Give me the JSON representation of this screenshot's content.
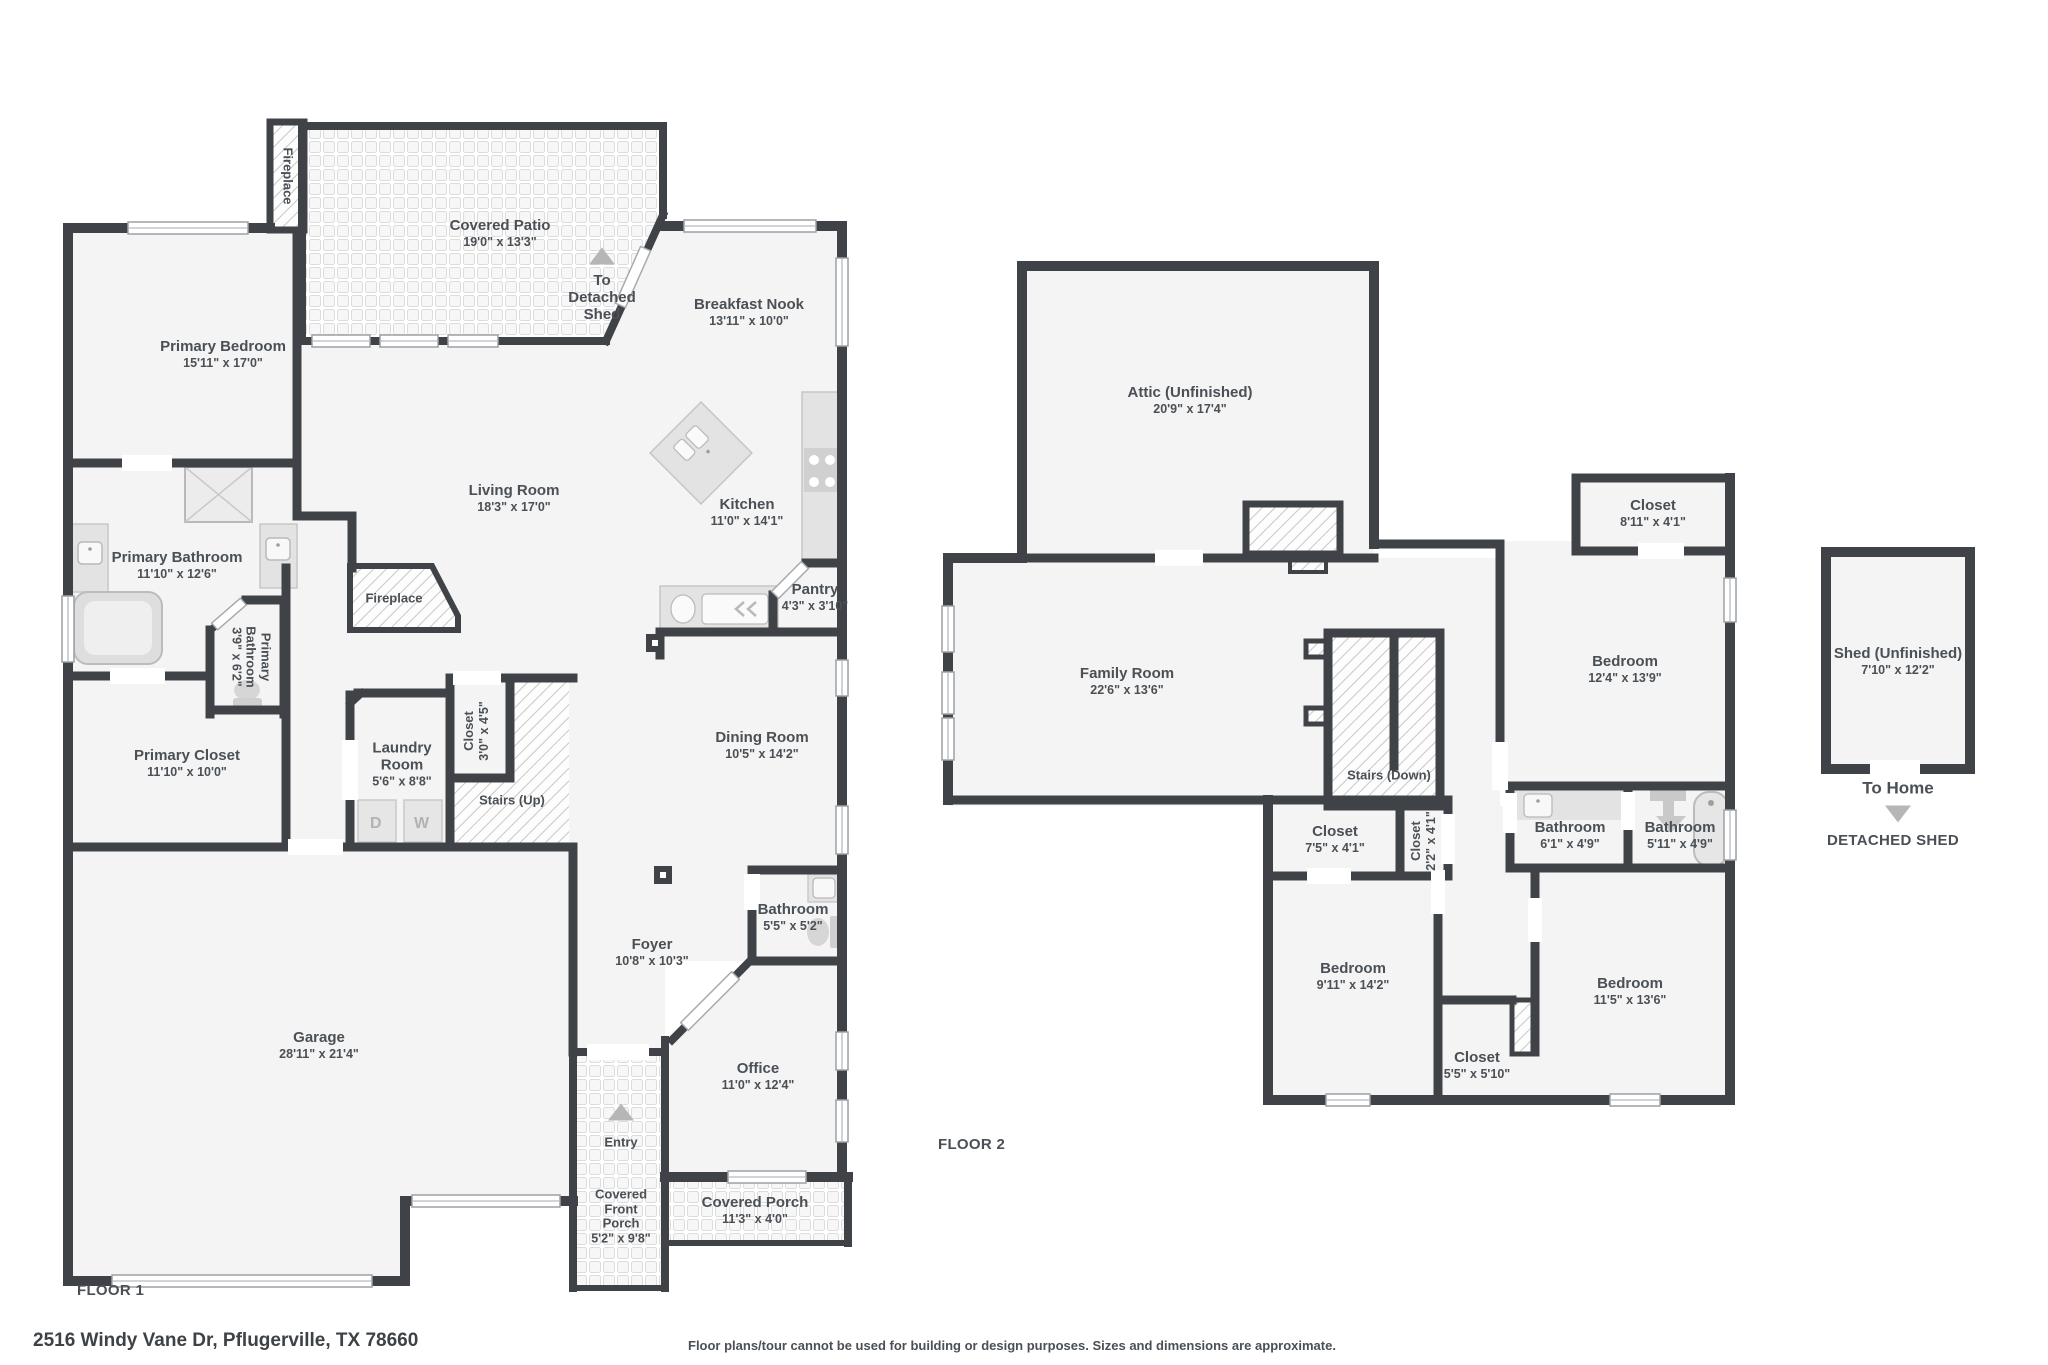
{
  "meta": {
    "address": "2516 Windy Vane Dr, Pflugerville, TX 78660",
    "disclaimer": "Floor plans/tour cannot be used for building or design purposes. Sizes and dimensions are approximate.",
    "wall_color": "#3f4347",
    "room_fill": "#f4f4f4",
    "text_color": "#4a5055"
  },
  "floor1": {
    "label": "FLOOR 1",
    "rooms": {
      "chimney_fireplace": {
        "name": "Fireplace"
      },
      "covered_patio": {
        "name": "Covered Patio",
        "dims": "19'0\" x 13'3\""
      },
      "to_detached_shed": {
        "name": "To Detached Shed"
      },
      "breakfast_nook": {
        "name": "Breakfast Nook",
        "dims": "13'11\" x 10'0\""
      },
      "primary_bedroom": {
        "name": "Primary Bedroom",
        "dims": "15'11\" x 17'0\""
      },
      "living_room": {
        "name": "Living Room",
        "dims": "18'3\" x 17'0\""
      },
      "kitchen": {
        "name": "Kitchen",
        "dims": "11'0\" x 14'1\""
      },
      "primary_bathroom": {
        "name": "Primary Bathroom",
        "dims": "11'10\" x 12'6\""
      },
      "fireplace": {
        "name": "Fireplace"
      },
      "pantry": {
        "name": "Pantry",
        "dims": "4'3\" x 3'10\""
      },
      "primary_bathroom_wc": {
        "name": "Primary Bathroom",
        "dims": "3'9\" x 6'2\""
      },
      "primary_closet": {
        "name": "Primary Closet",
        "dims": "11'10\" x 10'0\""
      },
      "laundry_room": {
        "name": "Laundry Room",
        "dims": "5'6\" x 8'8\""
      },
      "closet": {
        "name": "Closet",
        "dims": "3'0\" x 4'5\""
      },
      "stairs_up": {
        "name": "Stairs (Up)"
      },
      "dining_room": {
        "name": "Dining Room",
        "dims": "10'5\" x 14'2\""
      },
      "bathroom": {
        "name": "Bathroom",
        "dims": "5'5\" x 5'2\""
      },
      "foyer": {
        "name": "Foyer",
        "dims": "10'8\" x 10'3\""
      },
      "garage": {
        "name": "Garage",
        "dims": "28'11\" x 21'4\""
      },
      "entry": {
        "name": "Entry"
      },
      "covered_front_porch": {
        "name": "Covered Front Porch",
        "dims": "5'2\" x 9'8\""
      },
      "office": {
        "name": "Office",
        "dims": "11'0\" x 12'4\""
      },
      "covered_porch": {
        "name": "Covered Porch",
        "dims": "11'3\" x 4'0\""
      }
    },
    "appliances": {
      "dryer": "D",
      "washer": "W"
    }
  },
  "floor2": {
    "label": "FLOOR 2",
    "rooms": {
      "attic": {
        "name": "Attic (Unfinished)",
        "dims": "20'9\" x 17'4\""
      },
      "family_room": {
        "name": "Family Room",
        "dims": "22'6\" x 13'6\""
      },
      "stairs_down": {
        "name": "Stairs (Down)"
      },
      "closet_75": {
        "name": "Closet",
        "dims": "7'5\" x 4'1\""
      },
      "closet_22": {
        "name": "Closet",
        "dims": "2'2\" x 4'1\""
      },
      "closet_811": {
        "name": "Closet",
        "dims": "8'11\" x 4'1\""
      },
      "bedroom_124": {
        "name": "Bedroom",
        "dims": "12'4\" x 13'9\""
      },
      "bathroom_61": {
        "name": "Bathroom",
        "dims": "6'1\" x 4'9\""
      },
      "bathroom_511": {
        "name": "Bathroom",
        "dims": "5'11\" x 4'9\""
      },
      "bedroom_911": {
        "name": "Bedroom",
        "dims": "9'11\" x 14'2\""
      },
      "closet_55": {
        "name": "Closet",
        "dims": "5'5\" x 5'10\""
      },
      "bedroom_115": {
        "name": "Bedroom",
        "dims": "11'5\" x 13'6\""
      }
    }
  },
  "shed": {
    "name": "Shed (Unfinished)",
    "dims": "7'10\" x 12'2\"",
    "to_home": "To Home",
    "caption": "DETACHED SHED"
  }
}
